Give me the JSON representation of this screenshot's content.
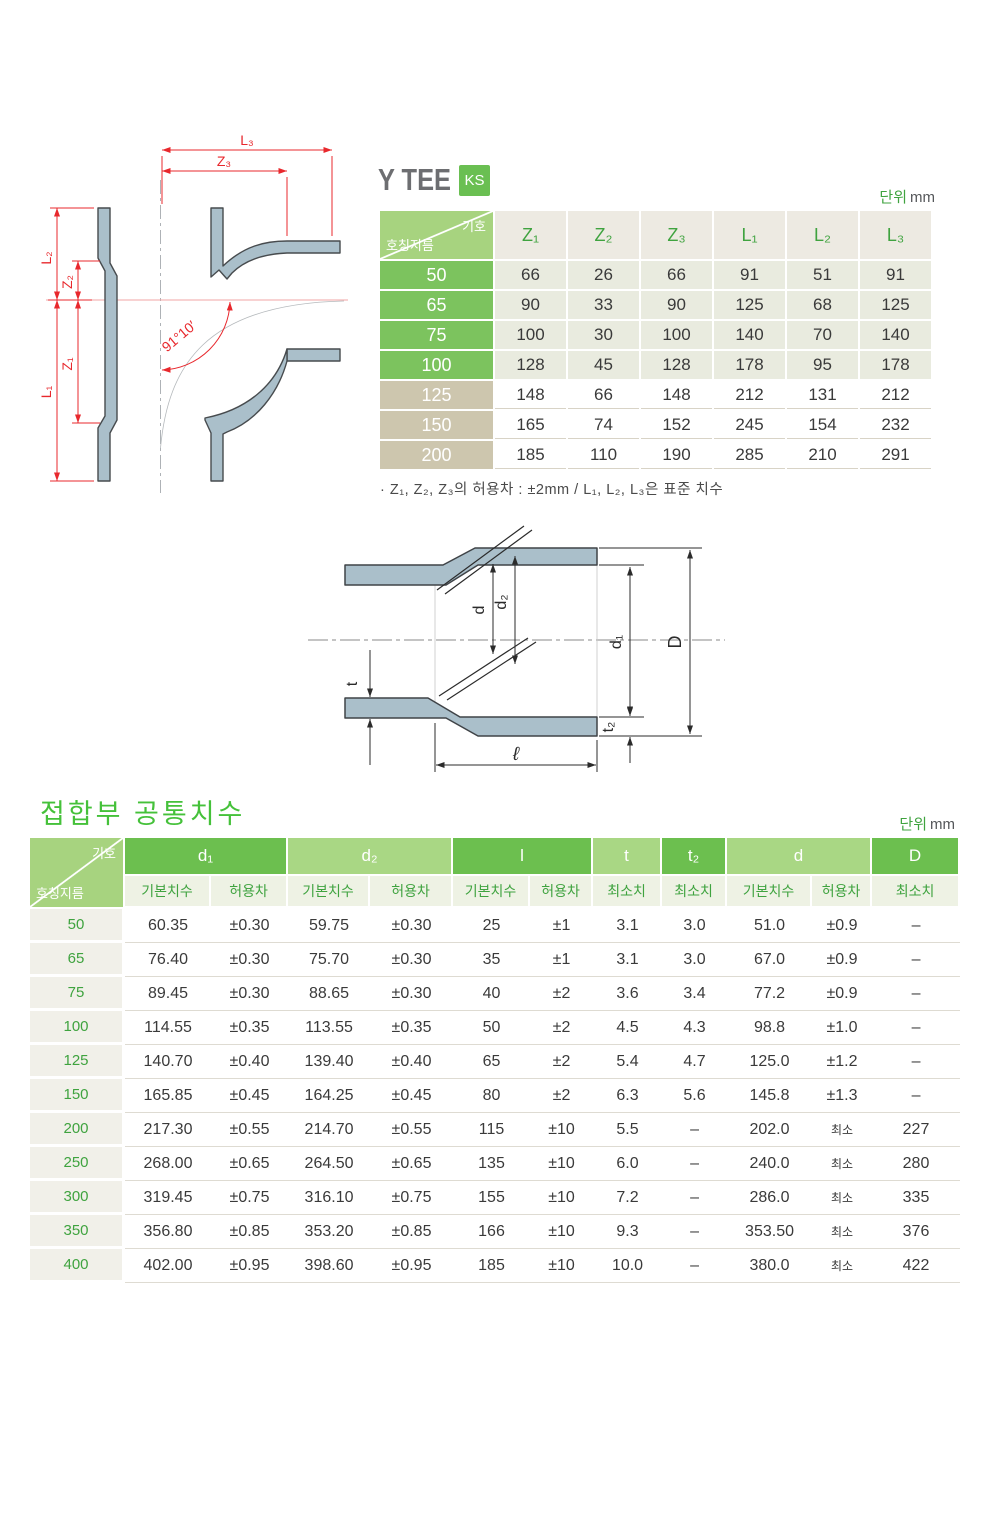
{
  "title": {
    "text": "Y TEE",
    "badge": "KS"
  },
  "units": {
    "label": "단위",
    "value": "mm"
  },
  "tee_table": {
    "corner_top": "기호",
    "corner_bottom": "호칭지름",
    "columns": [
      "Z₁",
      "Z₂",
      "Z₃",
      "L₁",
      "L₂",
      "L₃"
    ],
    "rows": [
      {
        "label": "50",
        "tone": "green",
        "values": [
          "66",
          "26",
          "66",
          "91",
          "51",
          "91"
        ]
      },
      {
        "label": "65",
        "tone": "green",
        "values": [
          "90",
          "33",
          "90",
          "125",
          "68",
          "125"
        ]
      },
      {
        "label": "75",
        "tone": "green",
        "values": [
          "100",
          "30",
          "100",
          "140",
          "70",
          "140"
        ]
      },
      {
        "label": "100",
        "tone": "green",
        "values": [
          "128",
          "45",
          "128",
          "178",
          "95",
          "178"
        ]
      },
      {
        "label": "125",
        "tone": "tan",
        "values": [
          "148",
          "66",
          "148",
          "212",
          "131",
          "212"
        ]
      },
      {
        "label": "150",
        "tone": "tan",
        "values": [
          "165",
          "74",
          "152",
          "245",
          "154",
          "232"
        ]
      },
      {
        "label": "200",
        "tone": "tan",
        "values": [
          "185",
          "110",
          "190",
          "285",
          "210",
          "291"
        ]
      }
    ],
    "footnote": "· Z₁, Z₂, Z₃의 허용차 : ±2mm / L₁, L₂, L₃은 표준 치수"
  },
  "joint_section": {
    "heading": "접합부 공통치수",
    "corner_top": "기호",
    "corner_bottom": "호칭지름",
    "groups": [
      {
        "label": "d₁",
        "span": 2,
        "tone": "dark"
      },
      {
        "label": "d₂",
        "span": 2,
        "tone": "light"
      },
      {
        "label": "l",
        "span": 2,
        "tone": "dark"
      },
      {
        "label": "t",
        "span": 1,
        "tone": "light"
      },
      {
        "label": "t₂",
        "span": 1,
        "tone": "dark"
      },
      {
        "label": "d",
        "span": 2,
        "tone": "light"
      },
      {
        "label": "D",
        "span": 1,
        "tone": "dark"
      }
    ],
    "subheaders": [
      "기본치수",
      "허용차",
      "기본치수",
      "허용차",
      "기본치수",
      "허용차",
      "최소치",
      "최소치",
      "기본치수",
      "허용차",
      "최소치"
    ],
    "rows": [
      {
        "label": "50",
        "values": [
          "60.35",
          "±0.30",
          "59.75",
          "±0.30",
          "25",
          "±1",
          "3.1",
          "3.0",
          "51.0",
          "±0.9",
          "–"
        ]
      },
      {
        "label": "65",
        "values": [
          "76.40",
          "±0.30",
          "75.70",
          "±0.30",
          "35",
          "±1",
          "3.1",
          "3.0",
          "67.0",
          "±0.9",
          "–"
        ]
      },
      {
        "label": "75",
        "values": [
          "89.45",
          "±0.30",
          "88.65",
          "±0.30",
          "40",
          "±2",
          "3.6",
          "3.4",
          "77.2",
          "±0.9",
          "–"
        ]
      },
      {
        "label": "100",
        "values": [
          "114.55",
          "±0.35",
          "113.55",
          "±0.35",
          "50",
          "±2",
          "4.5",
          "4.3",
          "98.8",
          "±1.0",
          "–"
        ]
      },
      {
        "label": "125",
        "values": [
          "140.70",
          "±0.40",
          "139.40",
          "±0.40",
          "65",
          "±2",
          "5.4",
          "4.7",
          "125.0",
          "±1.2",
          "–"
        ]
      },
      {
        "label": "150",
        "values": [
          "165.85",
          "±0.45",
          "164.25",
          "±0.45",
          "80",
          "±2",
          "6.3",
          "5.6",
          "145.8",
          "±1.3",
          "–"
        ]
      },
      {
        "label": "200",
        "values": [
          "217.30",
          "±0.55",
          "214.70",
          "±0.55",
          "115",
          "±10",
          "5.5",
          "–",
          "202.0",
          "최소",
          "227"
        ]
      },
      {
        "label": "250",
        "values": [
          "268.00",
          "±0.65",
          "264.50",
          "±0.65",
          "135",
          "±10",
          "6.0",
          "–",
          "240.0",
          "최소",
          "280"
        ]
      },
      {
        "label": "300",
        "values": [
          "319.45",
          "±0.75",
          "316.10",
          "±0.75",
          "155",
          "±10",
          "7.2",
          "–",
          "286.0",
          "최소",
          "335"
        ]
      },
      {
        "label": "350",
        "values": [
          "356.80",
          "±0.85",
          "353.20",
          "±0.85",
          "166",
          "±10",
          "9.3",
          "–",
          "353.50",
          "최소",
          "376"
        ]
      },
      {
        "label": "400",
        "values": [
          "402.00",
          "±0.95",
          "398.60",
          "±0.95",
          "185",
          "±10",
          "10.0",
          "–",
          "380.0",
          "최소",
          "422"
        ]
      }
    ]
  },
  "diagrams": {
    "tee": {
      "L3": "L₃",
      "Z3": "Z₃",
      "L2": "L₂",
      "Z2": "Z₂",
      "Z1": "Z₁",
      "L1": "L₁",
      "angle": "91°10′"
    },
    "joint": {
      "t": "t",
      "d": "d",
      "d2": "d₂",
      "d1": "d₁",
      "t2": "t₂",
      "D": "D",
      "l": "ℓ"
    }
  },
  "colors": {
    "green_dark": "#6cbf4f",
    "green_light": "#a9d784",
    "corner_green": "#a7d37f",
    "row_green": "#7cc35e",
    "row_tan": "#cdc6ae",
    "text_green": "#3fa33f",
    "badge_green": "#6abf52",
    "heading_green": "#45c13a",
    "pipe_fill": "#aabfca",
    "dim_red": "#e8282d"
  }
}
